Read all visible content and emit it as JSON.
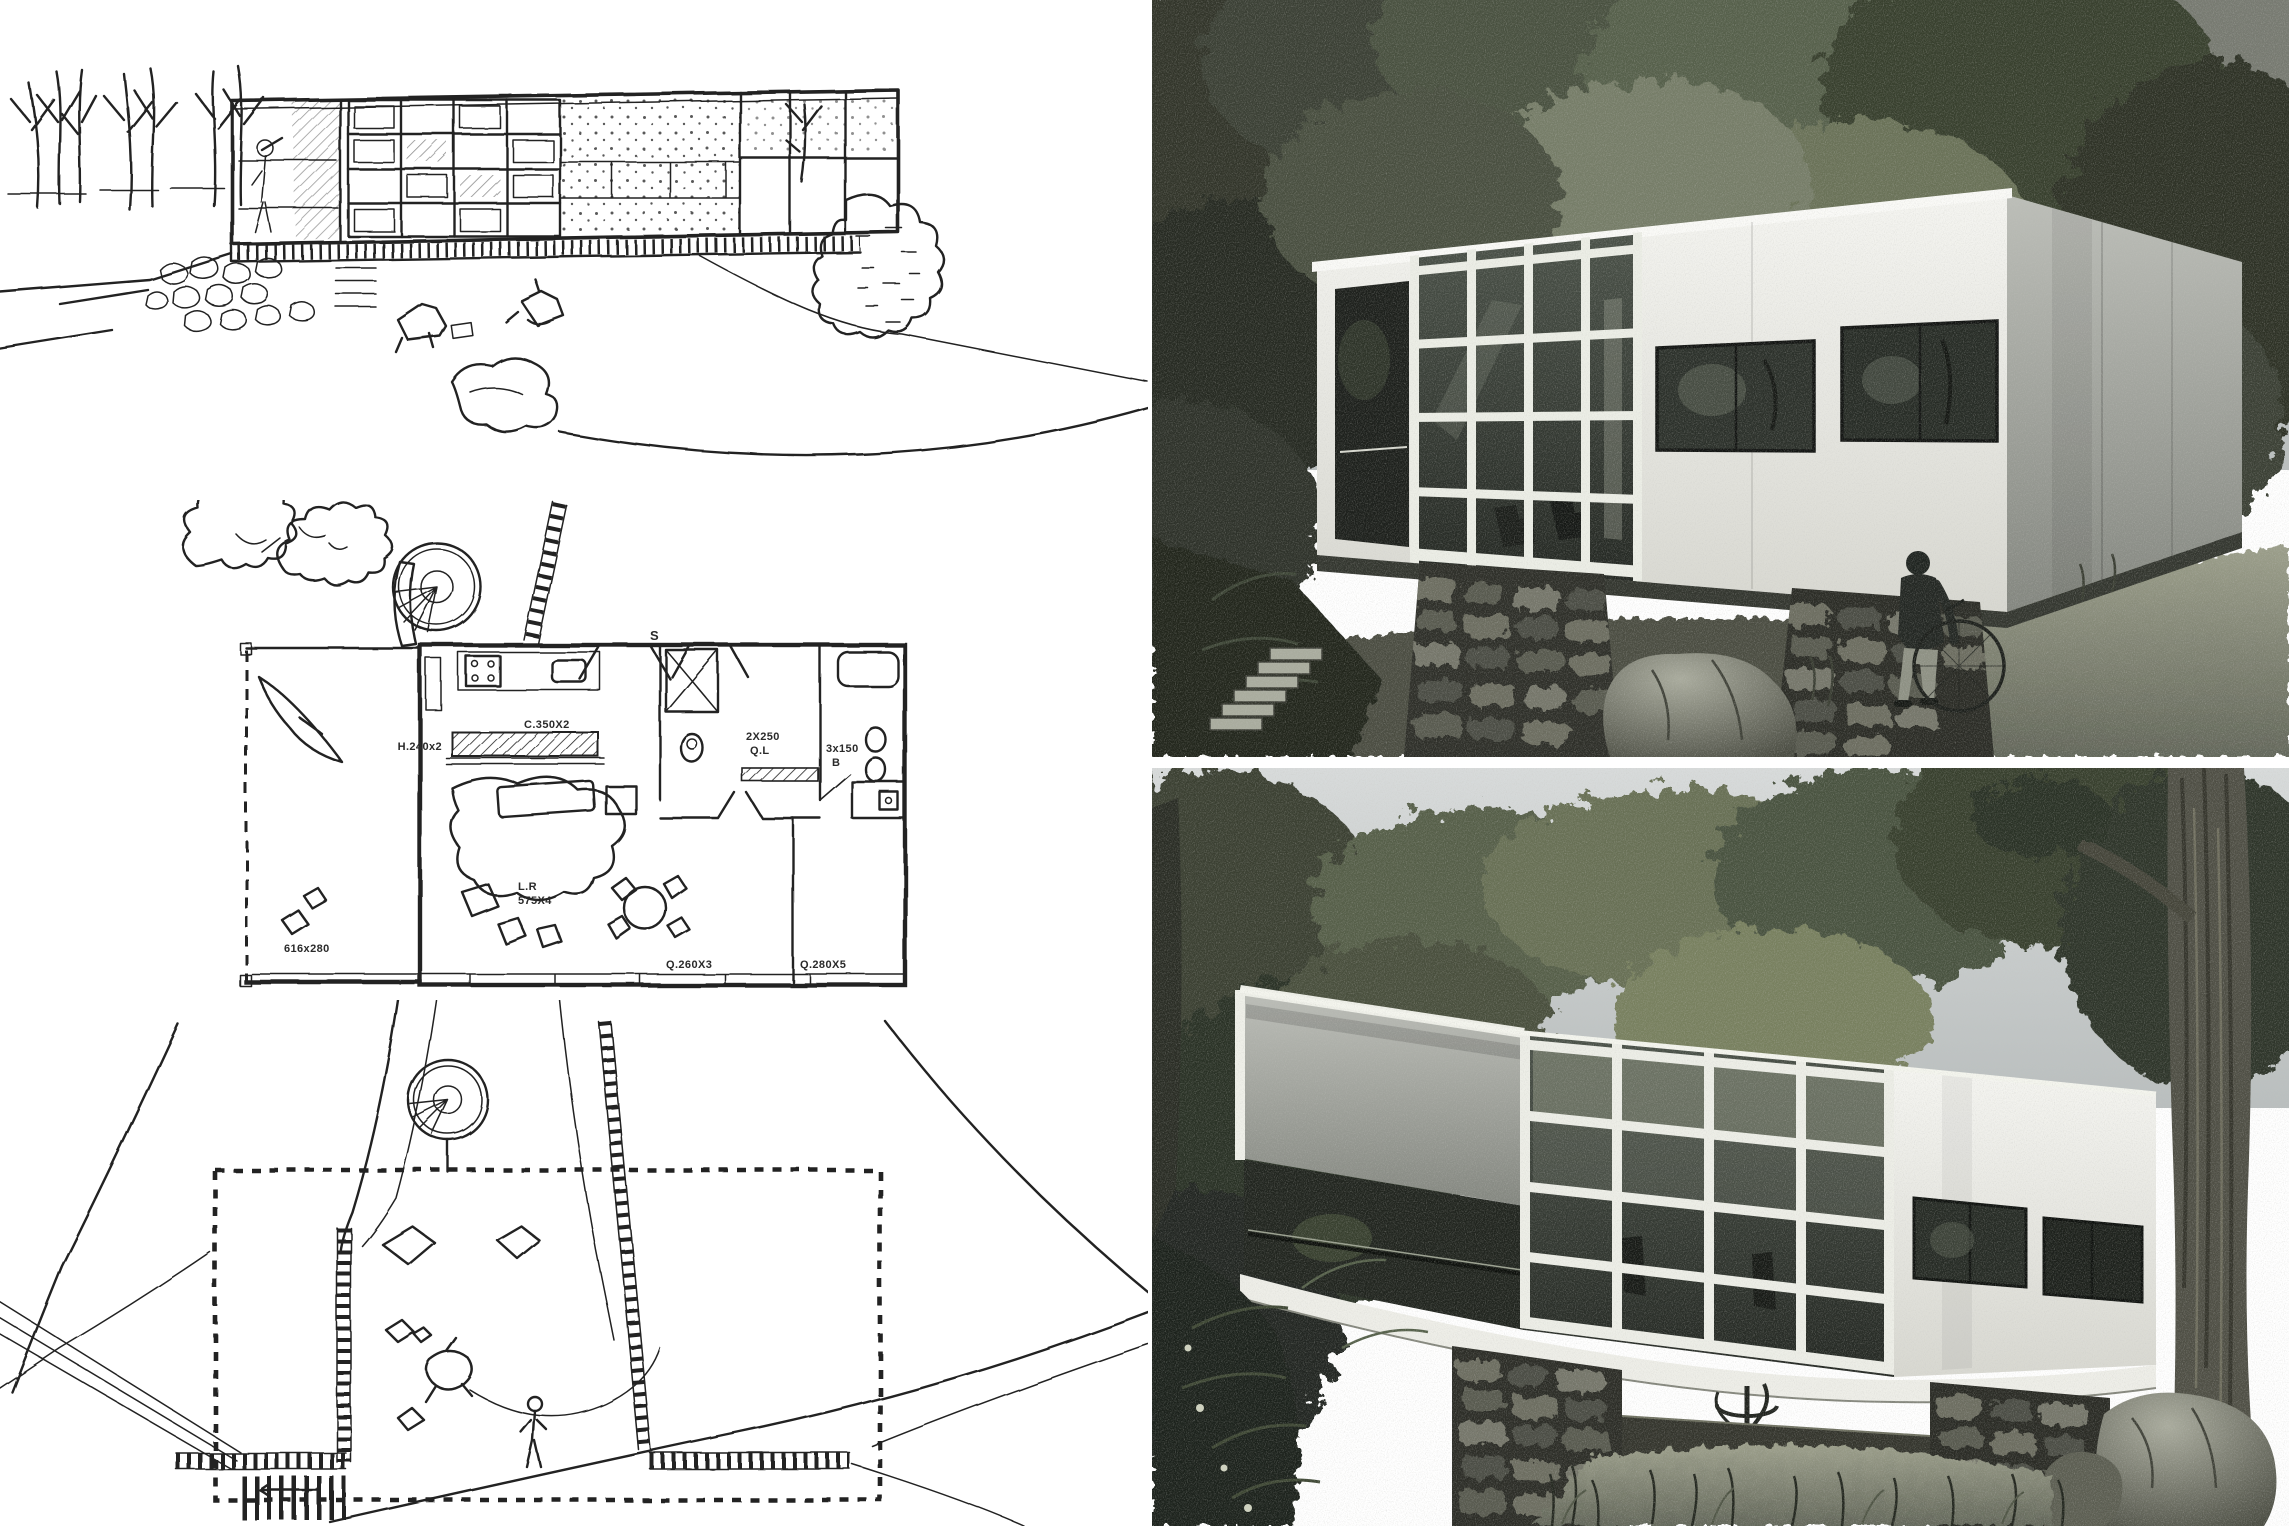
{
  "collage": {
    "background": "#ffffff",
    "gap_color": "#ffffff"
  },
  "sketches": {
    "perspective_alt": "Pencil perspective sketch of a long glass-fronted modernist house on a rubble stone base, bare trees at left, rocks and shrubs around",
    "floor_plan_alt": "Hand-drawn floor plan with open terrace, living room, kitchen shelf, two bedrooms, bathrooms, spiral stair and ramp",
    "site_plan_alt": "Hand-drawn site plan with dashed house footprint, stone retaining walls, stairs, spiral stair and terrain contour lines"
  },
  "floor_plan": {
    "labels": {
      "entry": "S",
      "closet": "H.240x2",
      "shelf": "C.350X2",
      "bath1_line1": "2X250",
      "bath1_line2": "Q.L",
      "bath2_line1": "3x150",
      "bath2_line2": "B",
      "living_line1": "L.R",
      "living_line2": "575X4",
      "terrace": "616x280",
      "bedroom1": "Q.260X3",
      "bedroom2": "Q.280X5"
    }
  },
  "photos": {
    "top": {
      "alt": "Black and white render of the white box house on rubble stone piers seen from the meadow, person with a bicycle at the corner, large rock in front"
    },
    "bottom": {
      "alt": "Black and white render of the cantilevered house from downhill, open veranda end, glass grid, spiral stair below slab, big tree trunk at right"
    }
  },
  "palette": {
    "ink": "#212121",
    "paper": "#ffffff",
    "sky": "#d7dadb",
    "house_white": "#f4f4f0",
    "glass": "#2c312b",
    "stone": "#2e2f29",
    "foliage_dark": "#2b3027",
    "foliage_light": "#677054",
    "meadow": "#9a9d89"
  }
}
